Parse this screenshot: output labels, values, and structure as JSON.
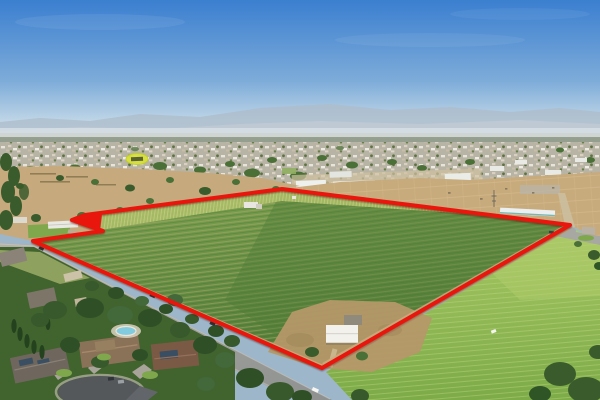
{
  "meta": {
    "description": "Aerial drone photograph of a rural orchard property outlined with a red boundary line. A two-lane road runs along the lower edge of the parcel, large suburban homes with a swimming pool and cul-de-sac sit in the foreground, a bright green open field lies to the right, and a town with industrial warehouses, a yellow-highlighted building and hazy mountains stretches across the horizon under a blue sky.",
    "width_px": 600,
    "height_px": 400
  },
  "palette": {
    "sky_top": "#3b7fd0",
    "sky_mid": "#7eacd9",
    "sky_haze": "#c6dae8",
    "horizon_haze": "#d8e1e7",
    "mountain_far": "#aebdcb",
    "mountain_near": "#bfcad4",
    "treeline_distant": "#8d9782",
    "town_base": "#b7b3a5",
    "dry_field": "#c6aa7d",
    "dirt_construction": "#c8ab7c",
    "orchard_top": "#7da351",
    "orchard_bottom": "#507c37",
    "young_rows": "#a8bd66",
    "field_top": "#a6c763",
    "field_bottom": "#7cab48",
    "road_gray": "#9a9b98",
    "asphalt_dark": "#55585a",
    "dirt_shoulder": "#c9ad7e",
    "tree_dark": "#3a5c2c",
    "tree_mid": "#4a7038",
    "lawn_green": "#7fa84d",
    "pool_blue": "#82cadd",
    "building_white": "#f2f1ec",
    "boundary_red": "#e8150c",
    "highlight_yellow": "#d8e23c"
  },
  "boundary": {
    "outline_points": "282,189 85,215 72,220 103,231 33,241 322,368 570,225",
    "arrow_points": "70,221 102,213 100,230",
    "stroke_width": "4"
  },
  "scene": {
    "regions": [
      "sky",
      "mountain-range",
      "distant-haze",
      "distant-town",
      "highlighted-building",
      "industrial-warehouses",
      "dirt-construction-area",
      "dry-field",
      "farmstead",
      "orchard-parcel",
      "red-property-boundary",
      "pointer-arrow",
      "frontage-road",
      "right-green-field",
      "residential-neighborhood",
      "swimming-pool",
      "cul-de-sac",
      "white-farm-building"
    ]
  }
}
